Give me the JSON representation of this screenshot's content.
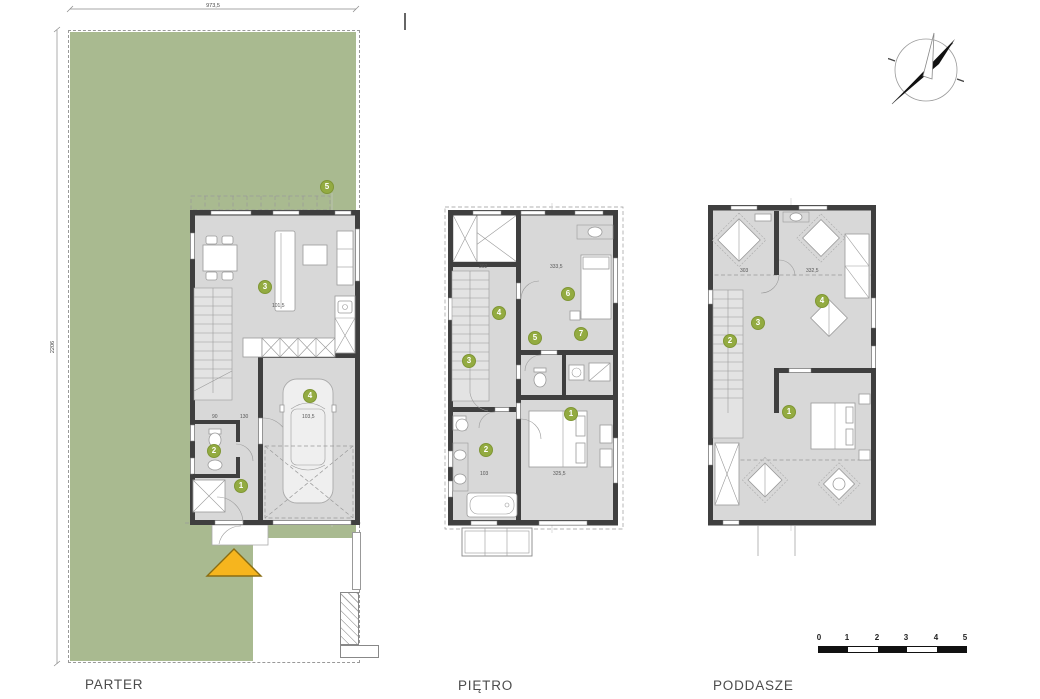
{
  "labels": {
    "parter": "PARTER",
    "pietro": "PIĘTRO",
    "poddasze": "PODDASZE"
  },
  "site": {
    "top_dim": "973,5",
    "left_dim": "2206",
    "garden_marker": "5"
  },
  "floors": {
    "parter": {
      "markers": [
        "1",
        "2",
        "3",
        "4"
      ],
      "dims": [
        "90",
        "130",
        "103,5",
        "101,5"
      ]
    },
    "pietro": {
      "markers": [
        "1",
        "2",
        "3",
        "4",
        "5",
        "6",
        "7"
      ],
      "dims": [
        "302",
        "333,5",
        "103",
        "325,5"
      ]
    },
    "poddasze": {
      "markers": [
        "1",
        "2",
        "3",
        "4"
      ],
      "dims": [
        "303",
        "332,5"
      ]
    }
  },
  "scalebar": {
    "ticks": [
      "0",
      "1",
      "2",
      "3",
      "4",
      "5"
    ]
  },
  "colors": {
    "plot": "#a9ba90",
    "wall": "#3f3f3f",
    "interior": "#d8d8d8",
    "marker": "#93ab41",
    "entrance_arrow": "#f6b51e"
  }
}
